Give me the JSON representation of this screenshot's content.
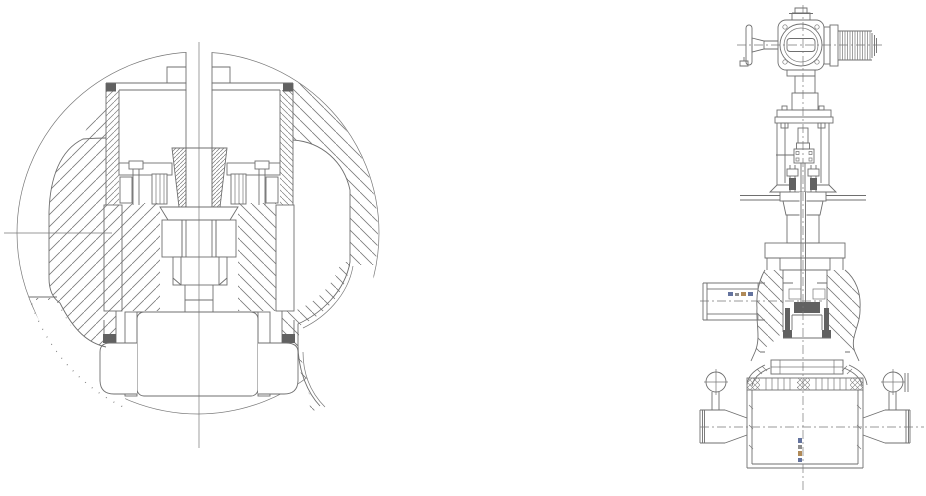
{
  "page": {
    "background": "#ffffff"
  },
  "drawing": {
    "type": "cad-engineering-drawing",
    "line_color": "#6f6f6f",
    "dark_fill": "#616161",
    "label_colors": {
      "blue": "#64739e",
      "tan": "#b08a58"
    },
    "views": [
      {
        "id": "detail",
        "label": "circular detail section of valve bonnet: stem, gland bushing, packing, threaded retainers and bottom plug"
      },
      {
        "id": "elevation",
        "label": "elevation section of motor-operated valve: handwheel, electric actuator, yoke, bonnet, globe body with side inlet nozzle, strainer ring and lower vessel with side nozzles"
      }
    ],
    "annotations": [
      {
        "id": "inlet-port-micro-label",
        "legible": false
      },
      {
        "id": "vessel-micro-label",
        "legible": false
      }
    ]
  }
}
